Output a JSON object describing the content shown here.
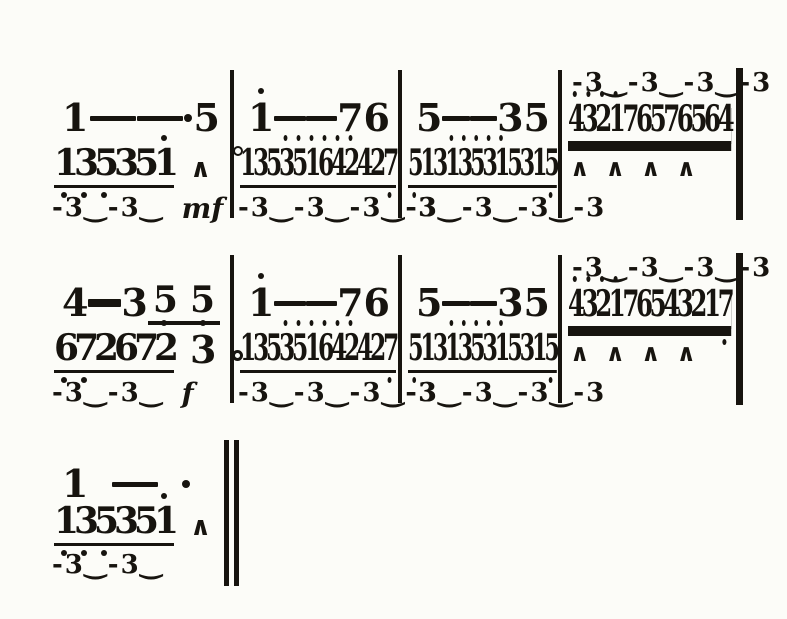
{
  "page": {
    "background": "#fcfcf8",
    "ink": "#17140f"
  },
  "score": {
    "notation": "jianpu-numbered-music",
    "systems": [
      {
        "name": "line-1",
        "final_bar": "single",
        "measures": [
          {
            "upper": [
              {
                "n": "1"
              },
              {
                "d": true
              },
              {
                "d": true
              },
              {
                "dot": true
              },
              {
                "n": "5"
              }
            ],
            "lower": [
              {
                "run": "135351",
                "above": [
                  5
                ],
                "below": [
                  0,
                  1,
                  2
                ]
              },
              {
                "acc": "∧"
              },
              {
                "circ": true
              }
            ],
            "trip": {
              "text": "-3‿-3‿",
              "dyn": "mf"
            }
          },
          {
            "upper": [
              {
                "n": "1",
                "hi": true
              },
              {
                "d": true
              },
              {
                "d": true
              },
              {
                "n": "7"
              },
              {
                "n": "6"
              }
            ],
            "lower": [
              {
                "run": "135351642427",
                "cond": true,
                "above": [
                  3,
                  4,
                  5,
                  6,
                  7,
                  8
                ],
                "below": [
                  11
                ]
              }
            ],
            "trip": {
              "text": "-3‿-3‿-3‿-3"
            }
          },
          {
            "upper": [
              {
                "n": "5"
              },
              {
                "d": true
              },
              {
                "d": true
              },
              {
                "n": "3"
              },
              {
                "n": "5"
              }
            ],
            "lower": [
              {
                "run": "513135315315",
                "cond": true,
                "above": [
                  3,
                  4,
                  5,
                  6,
                  7
                ],
                "below": [
                  0,
                  11
                ]
              }
            ],
            "trip": {
              "text": "-3‿-3‿-3‿-3"
            }
          },
          {
            "trip_above": {
              "text": "-3‿-3‿-3‿-3"
            },
            "lower": [
              {
                "run": "432176576564",
                "cond": true,
                "dbl": true,
                "above": [
                  0,
                  1,
                  2,
                  3
                ]
              }
            ],
            "accents": [
              "∧",
              "∧",
              "∧",
              "∧"
            ]
          }
        ]
      },
      {
        "name": "line-2",
        "final_bar": "single",
        "measures": [
          {
            "upper": [
              {
                "n": "4"
              },
              {
                "d": true,
                "tk": true
              },
              {
                "n": "3"
              },
              {
                "grp": [
                  "5",
                  "5"
                ]
              }
            ],
            "lower": [
              {
                "run": "672672",
                "above": [
                  5
                ],
                "below": [
                  0,
                  1
                ]
              },
              {
                "n": "3",
                "hi": true
              },
              {
                "adot": true
              }
            ],
            "trip": {
              "text": "-3‿-3‿",
              "dyn": "f"
            }
          },
          {
            "upper": [
              {
                "n": "1",
                "hi": true
              },
              {
                "d": true
              },
              {
                "d": true
              },
              {
                "n": "7"
              },
              {
                "n": "6"
              }
            ],
            "lower": [
              {
                "run": "135351642427",
                "cond": true,
                "above": [
                  3,
                  4,
                  5,
                  6,
                  7,
                  8
                ],
                "below": [
                  11
                ]
              }
            ],
            "trip": {
              "text": "-3‿-3‿-3‿-3"
            }
          },
          {
            "upper": [
              {
                "n": "5"
              },
              {
                "d": true
              },
              {
                "d": true
              },
              {
                "n": "3"
              },
              {
                "n": "5"
              }
            ],
            "lower": [
              {
                "run": "513135315315",
                "cond": true,
                "above": [
                  3,
                  4,
                  5,
                  6,
                  7
                ],
                "below": [
                  0,
                  11
                ]
              }
            ],
            "trip": {
              "text": "-3‿-3‿-3‿-3"
            }
          },
          {
            "trip_above": {
              "text": "-3‿-3‿-3‿-3"
            },
            "lower": [
              {
                "run": "432176543217",
                "cond": true,
                "dbl": true,
                "above": [
                  0,
                  1,
                  2,
                  3
                ],
                "below": [
                  11
                ]
              }
            ],
            "accents": [
              "∧",
              "∧",
              "∧",
              "∧"
            ]
          }
        ]
      },
      {
        "name": "line-3",
        "final_bar": "double",
        "measures": [
          {
            "upper": [
              {
                "n": "1"
              },
              {
                "d": true
              },
              {
                "dot": true
              }
            ],
            "lower": [
              {
                "run": "135351",
                "above": [
                  5
                ],
                "below": [
                  0,
                  1,
                  2
                ]
              },
              {
                "acc": "∧"
              }
            ],
            "trip": {
              "text": "-3‿-3‿"
            }
          }
        ]
      }
    ]
  }
}
